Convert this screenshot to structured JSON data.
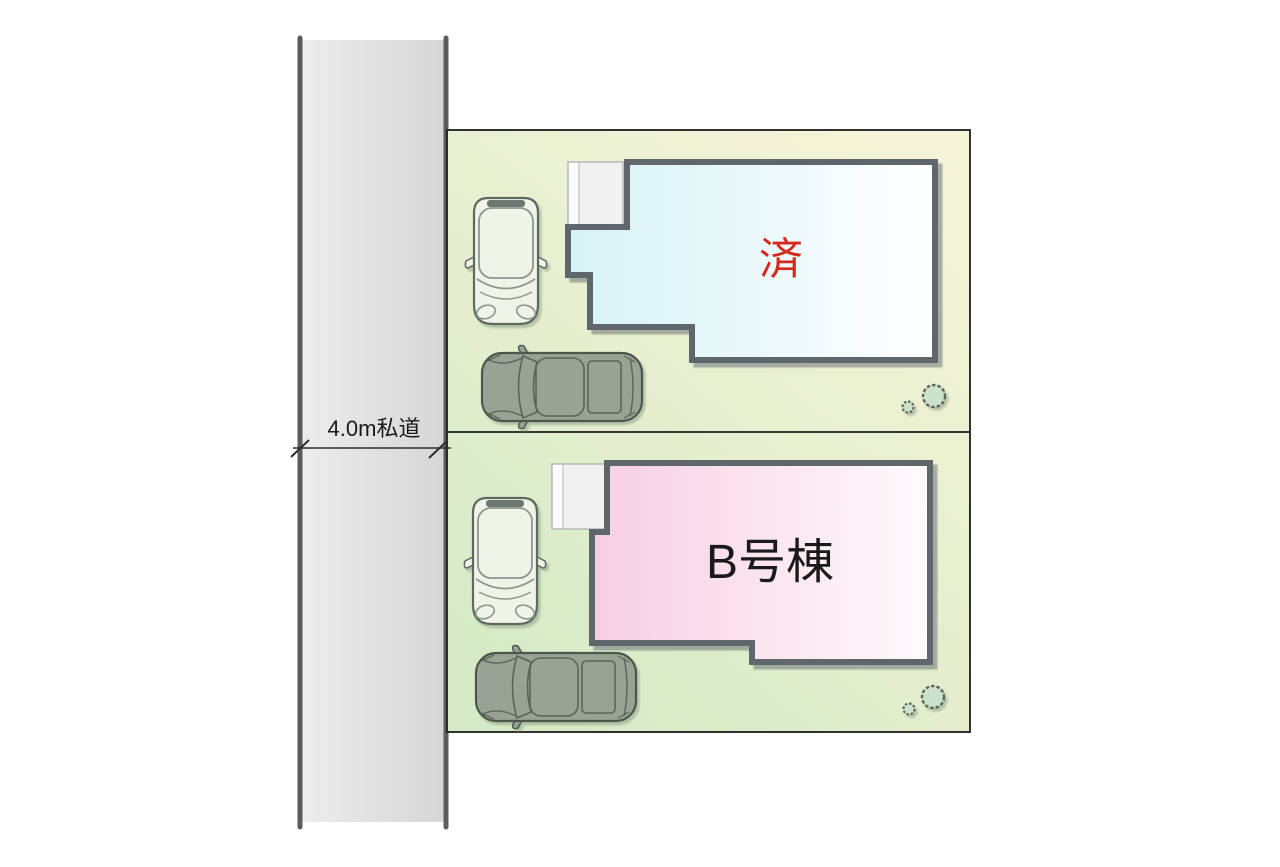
{
  "road": {
    "label": "4.0m私道",
    "label_color": "#1a1a1a",
    "surface_color_left": "#ededed",
    "surface_color_right": "#d6d6d6",
    "edge_color": "#5c5c5c",
    "dimension_line_color": "#2d2d2d"
  },
  "site": {
    "ground_color_yellow": "#f6f4d8",
    "ground_color_green": "#d5eac6",
    "border_color": "#1c1c1c"
  },
  "lot_a": {
    "building_label": "済",
    "building_label_color": "#d42a1e",
    "building_fill_left": "#d6f2f6",
    "building_fill_right": "#ffffff",
    "building_outline_color": "#5f666c",
    "objects": [
      "entrance-porch",
      "compact-car-top-view",
      "sedan-top-view",
      "shrub-small",
      "shrub-large"
    ]
  },
  "lot_b": {
    "building_label": "B号棟",
    "building_label_color": "#1a1a1a",
    "building_fill_left": "#f6cfe1",
    "building_fill_right": "#fffafc",
    "building_outline_color": "#5f666c",
    "objects": [
      "entrance-porch",
      "compact-car-top-view",
      "sedan-top-view",
      "shrub-small",
      "shrub-large"
    ]
  },
  "vehicles": {
    "compact_car_color": "#eef5e8",
    "compact_car_outline": "#5e6961",
    "sedan_color": "#99a395",
    "sedan_outline": "#4d564b"
  },
  "landscape": {
    "shrub_fill": "#cbe3cb",
    "shrub_outline": "#60665c"
  }
}
